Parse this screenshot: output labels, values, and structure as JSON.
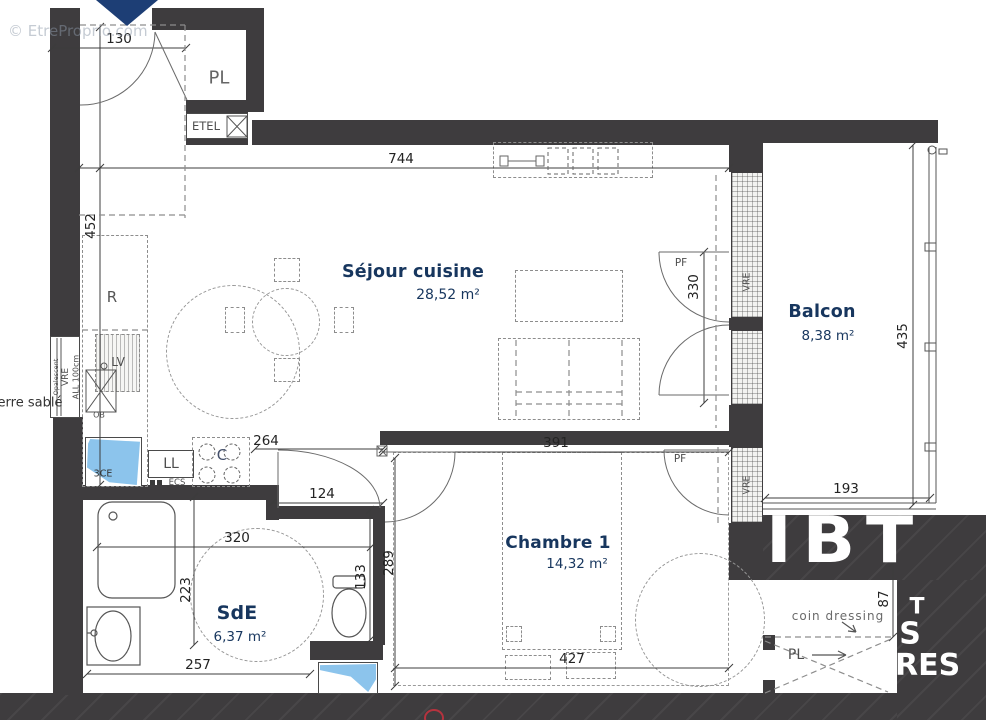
{
  "plan": {
    "rooms": {
      "sejour": {
        "name": "Séjour cuisine",
        "area": "28,52 m²"
      },
      "balcon": {
        "name": "Balcon",
        "area": "8,38 m²"
      },
      "chambre": {
        "name": "Chambre 1",
        "area": "14,32 m²"
      },
      "sde": {
        "name": "SdE",
        "area": "6,37 m²"
      }
    },
    "labels": {
      "pl": "PL",
      "etel": "ETEL",
      "r": "R",
      "lv": "LV",
      "ob": "OB",
      "tce": "3CE",
      "ll": "LL",
      "ecs": "ECS",
      "c": "C",
      "pf": "PF",
      "vre": "VRE",
      "all100": "ALL 100cm",
      "opalescent": "Opalescent",
      "verre_sable": "erre sablé",
      "coin_dressing": "coin dressing",
      "pl_arrow": "PL"
    },
    "dimensions": {
      "d130": "130",
      "d452": "452",
      "d744": "744",
      "d264": "264",
      "d124": "124",
      "d320": "320",
      "d223": "223",
      "d257": "257",
      "d133": "133",
      "d391": "391",
      "d289": "289",
      "d427": "427",
      "d330": "330",
      "d435": "435",
      "d193": "193",
      "d87": "87"
    },
    "watermark": {
      "copyright": "© EtreProprio.com",
      "big": "IBT",
      "frag_t": "T",
      "frag_s": "S",
      "frag_res": "RES"
    },
    "colors": {
      "wall": "#3e3c3e",
      "room_label_navy": "#17365e",
      "duct_blue": "#8cc4ec",
      "entrance_arrow_blue": "#1d3e75"
    }
  }
}
